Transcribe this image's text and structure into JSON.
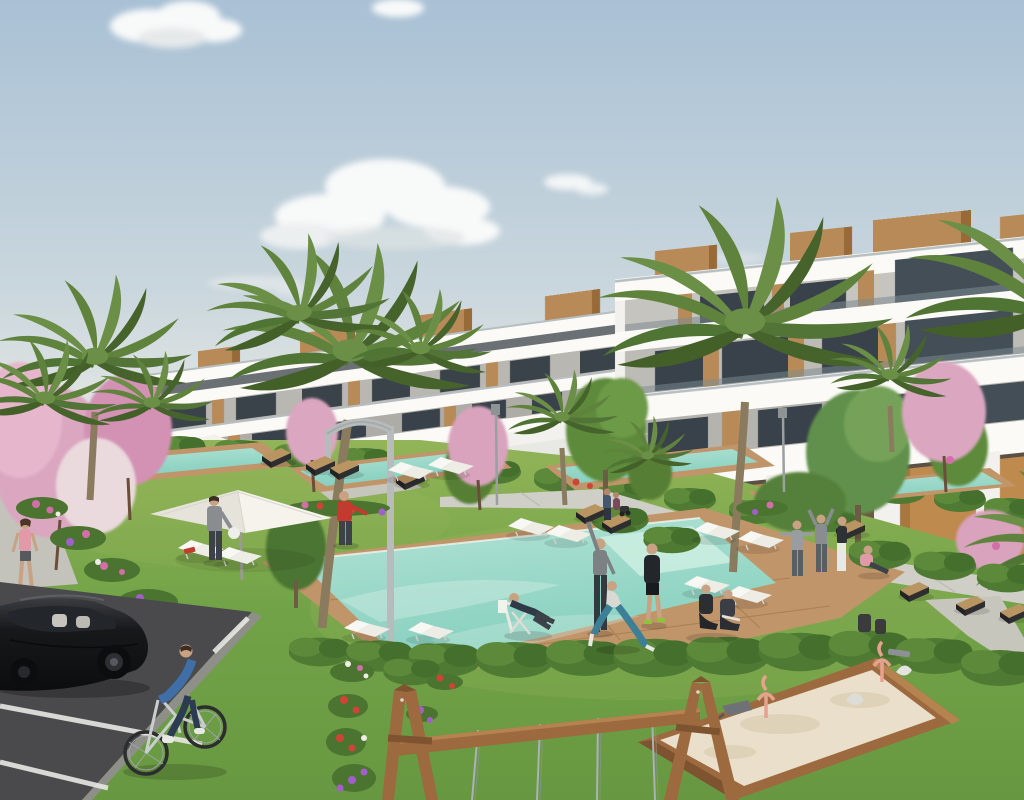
{
  "meta": {
    "description": "Architectural rendering of a modern white terraced apartment complex with communal gardens, turquoise pools, palm trees, playground and parking",
    "width": 1024,
    "height": 800
  },
  "palette": {
    "sky_top": "#a9c1d5",
    "sky_mid": "#c9d6dd",
    "sky_horizon": "#e8e9e5",
    "cloud_white": "#f8f9f9",
    "cloud_shadow": "#d3d8da",
    "building_white": "#f2f1ed",
    "fascia_white": "#fbfaf7",
    "wall_shadow": "#d9d8d4",
    "window_dark": "#39424a",
    "recess_dark": "#5d6467",
    "wood_accent": "#b78a57",
    "wood_dark": "#8f6231",
    "ochre_wall": "#bf8a4e",
    "glass_rail": "#8a979e",
    "palm_green": "#5f833d",
    "palm_dark": "#47632c",
    "tree_green": "#5d8a3a",
    "blossom_pink": "#dba6c0",
    "lawn_light": "#93b458",
    "lawn": "#73a348",
    "lawn_deep": "#679841",
    "hedge_green": "#44702e",
    "pool_light": "#b2e2d4",
    "pool_teal": "#84cfbe",
    "deck_wood": "#c0956a",
    "deck_line": "#a17947",
    "path_gray": "#cfcfc7",
    "sidewalk_gray": "#c3c3bb",
    "asphalt": "#4a4a4d",
    "line_white": "#e8e8e4",
    "car_black": "#17181a",
    "sand": "#e9dfca",
    "frame_wood": "#9c6a3e",
    "lamp_gray": "#b7bbbb",
    "accent_red": "#c23b2e",
    "accent_blue": "#3f6fa6",
    "accent_pink": "#e29aa8",
    "skin": "#c9a183",
    "toy_pink": "#e8a18e"
  },
  "scene": {
    "sky": {
      "label": "pale blue morning sky with scattered clouds",
      "cloud_count": 5
    },
    "building": {
      "label": "stepped white apartment block rising to the right",
      "floors_visible": 4,
      "features": [
        "wooden rooftop volumes",
        "glass balustrade terraces",
        "dark recessed windows",
        "ochre ground-floor walls",
        "white arched pier"
      ]
    },
    "vegetation": {
      "palm_trees": 10,
      "pink_blossom_trees": 6,
      "green_trees": 6,
      "hedges": "clipped hedge rows along paths and lawns",
      "flower_beds": "pink, purple, red and white flower clusters"
    },
    "pools": {
      "count": 4,
      "label": "terraced turquoise pools with timber decks"
    },
    "amenities": [
      "white cantilever parasol",
      "white sun loungers",
      "dark angular benches",
      "arched grey lamp",
      "garden light posts",
      "timber sandbox with spring riders",
      "timber swing frame with chains"
    ],
    "people": [
      "woman in pink top walking on left path",
      "man in grey holding a white ball",
      "man in red shirt reaching out",
      "man reclining on deck chair by pool",
      "man stretching with raised arm",
      "man in black sportswear",
      "woman lunging in blue leggings",
      "two people kneeling on lawn",
      "two people exercising on walkway",
      "woman in white trousers standing",
      "person sitting on walkway in pink",
      "cyclist in blue sweater on bicycle",
      "two small figures with stroller near building"
    ],
    "vehicles": [
      "black hatchback parked on asphalt",
      "bicycle"
    ]
  }
}
